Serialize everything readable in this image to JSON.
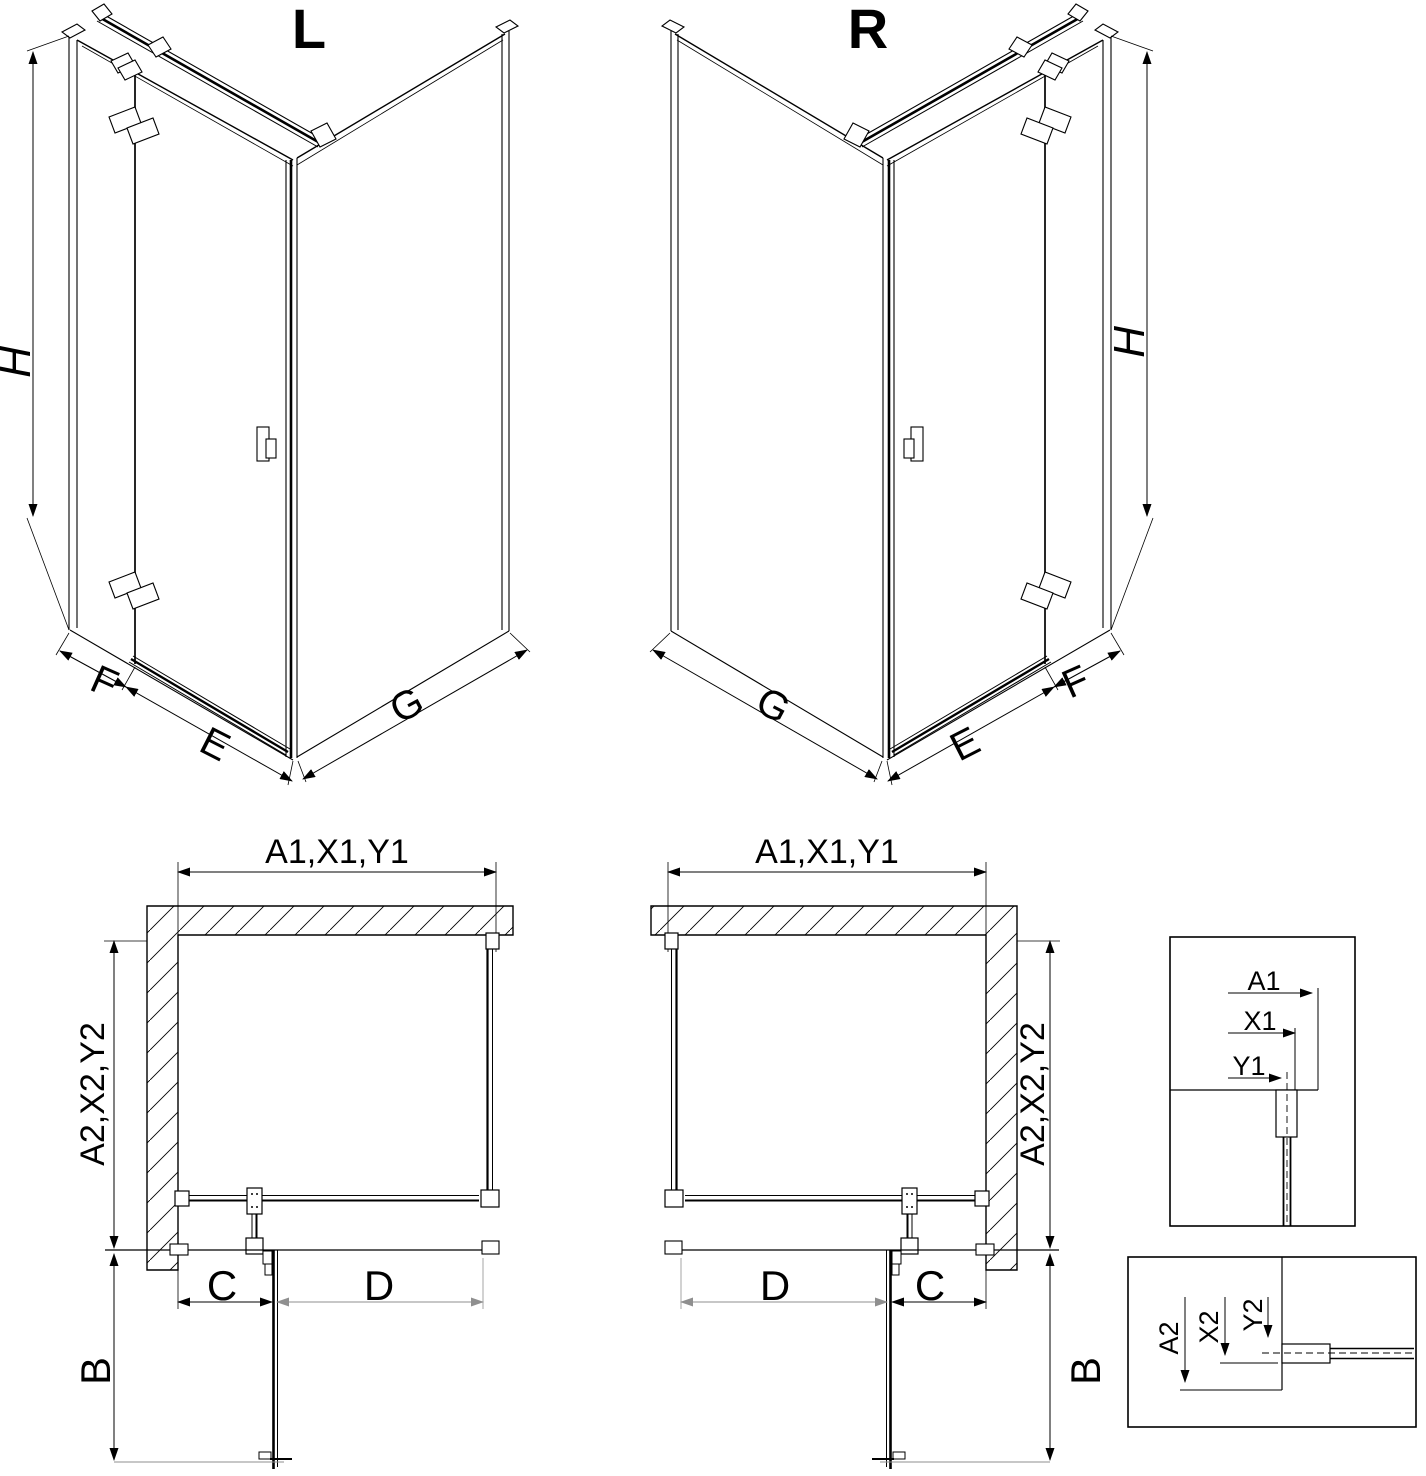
{
  "colors": {
    "line": "#000000",
    "dim_alt": "#8f8f8f",
    "background": "#ffffff"
  },
  "views": {
    "left_3d": {
      "title": "L",
      "dim_height": "H",
      "dim_f": "F",
      "dim_e": "E",
      "dim_g": "G"
    },
    "right_3d": {
      "title": "R",
      "dim_height": "H",
      "dim_f": "F",
      "dim_e": "E",
      "dim_g": "G"
    },
    "left_plan": {
      "dim_top": "A1,X1,Y1",
      "dim_side": "A2,X2,Y2",
      "dim_b": "B",
      "dim_c": "C",
      "dim_d": "D"
    },
    "right_plan": {
      "dim_top": "A1,X1,Y1",
      "dim_side": "A2,X2,Y2",
      "dim_b": "B",
      "dim_c": "C",
      "dim_d": "D"
    },
    "detail_top": {
      "dim_a1": "A1",
      "dim_x1": "X1",
      "dim_y1": "Y1"
    },
    "detail_bottom": {
      "dim_a2": "A2",
      "dim_x2": "X2",
      "dim_y2": "Y2"
    }
  }
}
